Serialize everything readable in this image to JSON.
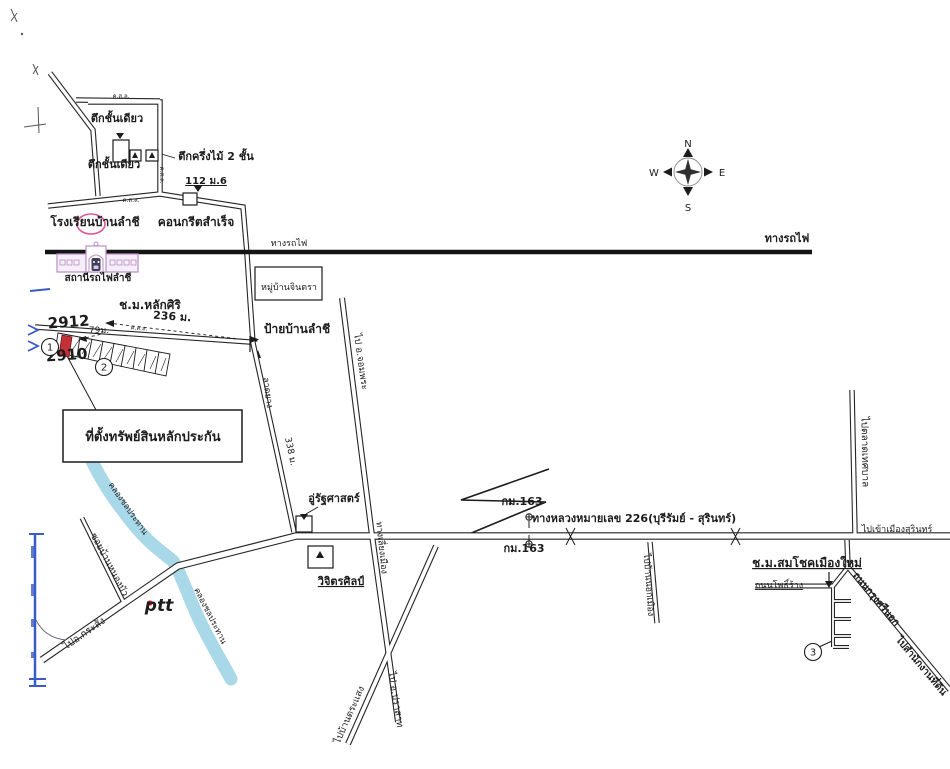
{
  "document_type": "hand-drawn location map (scanned)",
  "compass": {
    "north": "N",
    "south": "S",
    "east": "E",
    "west": "W"
  },
  "colors": {
    "ink": "#1c1c1c",
    "road": "#262626",
    "canal": "#a9d8e8",
    "station_stroke": "#b98fc6",
    "station_fill": "#f6eef8",
    "train": "#433d5c",
    "plot_red": "#c23038",
    "highlight_pink": "#e0559a",
    "blue_mark": "#3a5cc5",
    "ptt_blue": "#2b3fae",
    "ptt_red": "#e02020"
  },
  "property_box": {
    "label": "ที่ตั้งทรัพย์สินหลักประกัน"
  },
  "map_labels": [
    {
      "id": "bldg-single-storey-1",
      "t": "ตึกชั้นเดียว",
      "x": 117,
      "y": 122,
      "s": 11,
      "b": 1
    },
    {
      "id": "bldg-single-storey-2",
      "t": "ตึกชั้นเดียว",
      "x": 114,
      "y": 168,
      "s": 11,
      "b": 1
    },
    {
      "id": "bldg-halfwood-2storey",
      "t": "ตึกครึ่งไม้ 2 ชั้น",
      "x": 216,
      "y": 160,
      "s": 11,
      "b": 1
    },
    {
      "id": "address-112-m6",
      "t": "112 ม.6",
      "x": 206,
      "y": 184,
      "s": 10,
      "b": 1,
      "u": 1
    },
    {
      "id": "school-banlamchi",
      "t": "โรงเรียนบ้านลำชี",
      "x": 95,
      "y": 226,
      "s": 12,
      "b": 1
    },
    {
      "id": "road-concrete",
      "t": "คอนกรีตสำเร็จ",
      "x": 196,
      "y": 226,
      "s": 12,
      "b": 1
    },
    {
      "id": "railway-label-small",
      "t": "ทางรถไฟ",
      "x": 289,
      "y": 246,
      "s": 9
    },
    {
      "id": "railway-label-main",
      "t": "ทางรถไฟ",
      "x": 787,
      "y": 242,
      "s": 11,
      "b": 1
    },
    {
      "id": "station-lamchi",
      "t": "สถานีรถไฟลำชี",
      "x": 98,
      "y": 281,
      "s": 10,
      "b": 1
    },
    {
      "id": "village-jintra",
      "t": "หมู่บ้านจินตรา",
      "x": 289,
      "y": 290,
      "s": 9
    },
    {
      "id": "chm-laksiri",
      "t": "ช.ม.หลักศิริ",
      "x": 150,
      "y": 309,
      "s": 12,
      "b": 1
    },
    {
      "id": "distance-236m",
      "t": "236 ม.",
      "x": 172,
      "y": 320,
      "s": 11,
      "b": 1,
      "rot": 4
    },
    {
      "id": "sign-banlamchi",
      "t": "ป้ายบ้านลำชี",
      "x": 297,
      "y": 333,
      "s": 12,
      "b": 1
    },
    {
      "id": "parcel-2912",
      "t": "2912",
      "x": 69,
      "y": 327,
      "s": 15,
      "b": 1,
      "rot": -4
    },
    {
      "id": "parcel-2910",
      "t": "2910",
      "x": 67,
      "y": 360,
      "s": 15,
      "b": 1,
      "rot": -4
    },
    {
      "id": "distance-79m",
      "t": "79ม.",
      "x": 99,
      "y": 333,
      "s": 9
    },
    {
      "id": "property-title",
      "t": "ที่ตั้งทรัพย์สินหลักประกัน",
      "x": 153,
      "y": 441,
      "s": 13,
      "b": 1
    },
    {
      "id": "road-latyang",
      "t": "ลาดยาง",
      "x": 265,
      "y": 393,
      "s": 9,
      "rot": 82
    },
    {
      "id": "distance-338m",
      "t": "338 ม.",
      "x": 288,
      "y": 452,
      "s": 9,
      "rot": 78
    },
    {
      "id": "to-chomphra",
      "t": "ไป อ.จอมพระ",
      "x": 358,
      "y": 362,
      "s": 9.5,
      "rot": 82
    },
    {
      "id": "canal-label-1",
      "t": "คลองชลประทาน",
      "x": 126,
      "y": 510,
      "s": 8.5,
      "rot": 55
    },
    {
      "id": "canal-label-2",
      "t": "คลองชลประทาน",
      "x": 208,
      "y": 617,
      "s": 8.5,
      "rot": 63
    },
    {
      "id": "soi-ban-nongbua",
      "t": "ซอยบ้านหนองบัว",
      "x": 107,
      "y": 566,
      "s": 9.5,
      "rot": 62
    },
    {
      "id": "to-krasang",
      "t": "ไปอ.กระสัง",
      "x": 86,
      "y": 636,
      "s": 10,
      "rot": -35
    },
    {
      "id": "ptt-logo-text",
      "t": "ptt",
      "x": 159,
      "y": 611,
      "s": 17,
      "b": 1,
      "it": 1,
      "col": "ptt_blue"
    },
    {
      "id": "garage-rattasat",
      "t": "อู่รัฐศาสตร์",
      "x": 334,
      "y": 502,
      "s": 11,
      "b": 1
    },
    {
      "id": "shop-wijitsin",
      "t": "วิจิตรศิลป์",
      "x": 341,
      "y": 585,
      "s": 11,
      "b": 1,
      "u": 1
    },
    {
      "id": "road-bypass",
      "t": "ทางเลี่ยงเมือง",
      "x": 379,
      "y": 548,
      "s": 9,
      "rot": 84
    },
    {
      "id": "km163-north",
      "t": "กม.163",
      "x": 522,
      "y": 505,
      "s": 11,
      "b": 1
    },
    {
      "id": "km163-south",
      "t": "กม.163",
      "x": 524,
      "y": 552,
      "s": 11,
      "b": 1
    },
    {
      "id": "highway-226",
      "t": "ทางหลวงหมายเลข 226(บุรีรัมย์ - สุรินทร์)",
      "x": 634,
      "y": 522,
      "s": 11,
      "b": 1
    },
    {
      "id": "to-nokmueang",
      "t": "ไปบ้านนอกเมือง",
      "x": 646,
      "y": 585,
      "s": 9,
      "rot": 86
    },
    {
      "id": "to-talat-thesaban",
      "t": "ไปตลาดเทศบาล",
      "x": 862,
      "y": 452,
      "s": 10,
      "rot": 89
    },
    {
      "id": "to-surin-city",
      "t": "ไปเข้าเมืองสุรินทร์",
      "x": 897,
      "y": 532,
      "s": 9
    },
    {
      "id": "chm-somchok",
      "t": "ช.ม.สมโชคเมืองใหม่",
      "x": 807,
      "y": 567,
      "s": 12,
      "b": 1,
      "u": 1
    },
    {
      "id": "thanon-phorang",
      "t": "ถนนโพธิ์ร้าง",
      "x": 779,
      "y": 588,
      "s": 9,
      "u": 1
    },
    {
      "id": "thanon-krungsi-nok",
      "t": "ถนนกรุงศรีนอก",
      "x": 874,
      "y": 601,
      "s": 10,
      "b": 1,
      "rot": 50
    },
    {
      "id": "to-land-office",
      "t": "ไปสำนักงานที่ดิน",
      "x": 919,
      "y": 668,
      "s": 10,
      "b": 1,
      "rot": 50
    },
    {
      "id": "to-prasat",
      "t": "ไป อ.ปราสาท",
      "x": 393,
      "y": 700,
      "s": 9.5,
      "rot": 81
    },
    {
      "id": "to-ban-trasaeng",
      "t": "ไปบ้านตระแสง",
      "x": 352,
      "y": 716,
      "s": 9.5,
      "rot": -66
    },
    {
      "id": "road-type-ksl-1",
      "t": "ค.ส.ล.",
      "x": 121,
      "y": 98,
      "s": 6
    },
    {
      "id": "road-type-ksl-2",
      "t": "ค.ส.ล.",
      "x": 131,
      "y": 202,
      "s": 6
    },
    {
      "id": "road-type-ksl-3",
      "t": "ค.ส.ล.",
      "x": 139,
      "y": 330,
      "s": 6,
      "rot": 4
    },
    {
      "id": "road-type-ksl-4",
      "t": "ค.ส.ล.",
      "x": 160,
      "y": 175,
      "s": 6,
      "rot": 90
    },
    {
      "id": "compass-n",
      "t": "N",
      "x": 688,
      "y": 147,
      "s": 10
    },
    {
      "id": "compass-s",
      "t": "S",
      "x": 688,
      "y": 211,
      "s": 10
    },
    {
      "id": "compass-w",
      "t": "W",
      "x": 654,
      "y": 176,
      "s": 10
    },
    {
      "id": "compass-e",
      "t": "E",
      "x": 722,
      "y": 176,
      "s": 10
    }
  ],
  "circled_numbers": [
    {
      "id": "plot-marker-1",
      "n": "1",
      "x": 50,
      "y": 347
    },
    {
      "id": "plot-marker-2",
      "n": "2",
      "x": 104,
      "y": 367
    },
    {
      "id": "plot-marker-3",
      "n": "3",
      "x": 813,
      "y": 652
    }
  ]
}
